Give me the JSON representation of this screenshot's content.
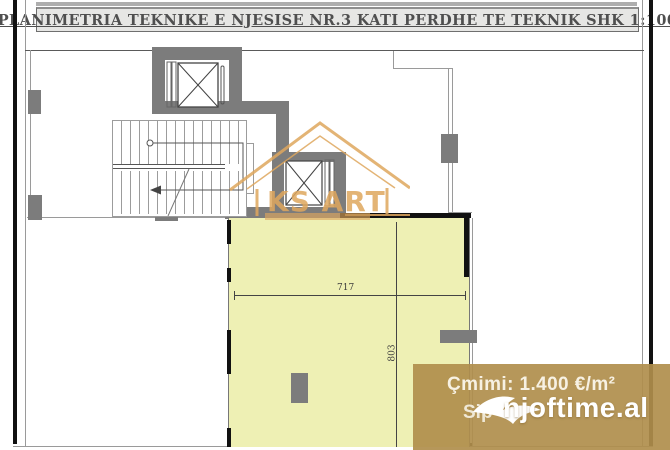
{
  "title": "PLANIMETRIA TEKNIKE E NJESISE NR.3 KATI PERDHE TE TEKNIK SHK 1:100",
  "plan": {
    "unit_width_label": "717",
    "unit_height_label": "803",
    "logo_text": "KS ART"
  },
  "overlay": {
    "price_line": "Çmimi: 1.400 €/m²",
    "area_line_partial": "Sip",
    "brand": "njoftime.al"
  },
  "colors": {
    "unit_fill": "#eef0b4",
    "wall_gray": "#7c7c7c",
    "logo_orange": "#dfa75e",
    "overlay_tan": "#b08e4c",
    "title_text": "#4f4f4f"
  }
}
